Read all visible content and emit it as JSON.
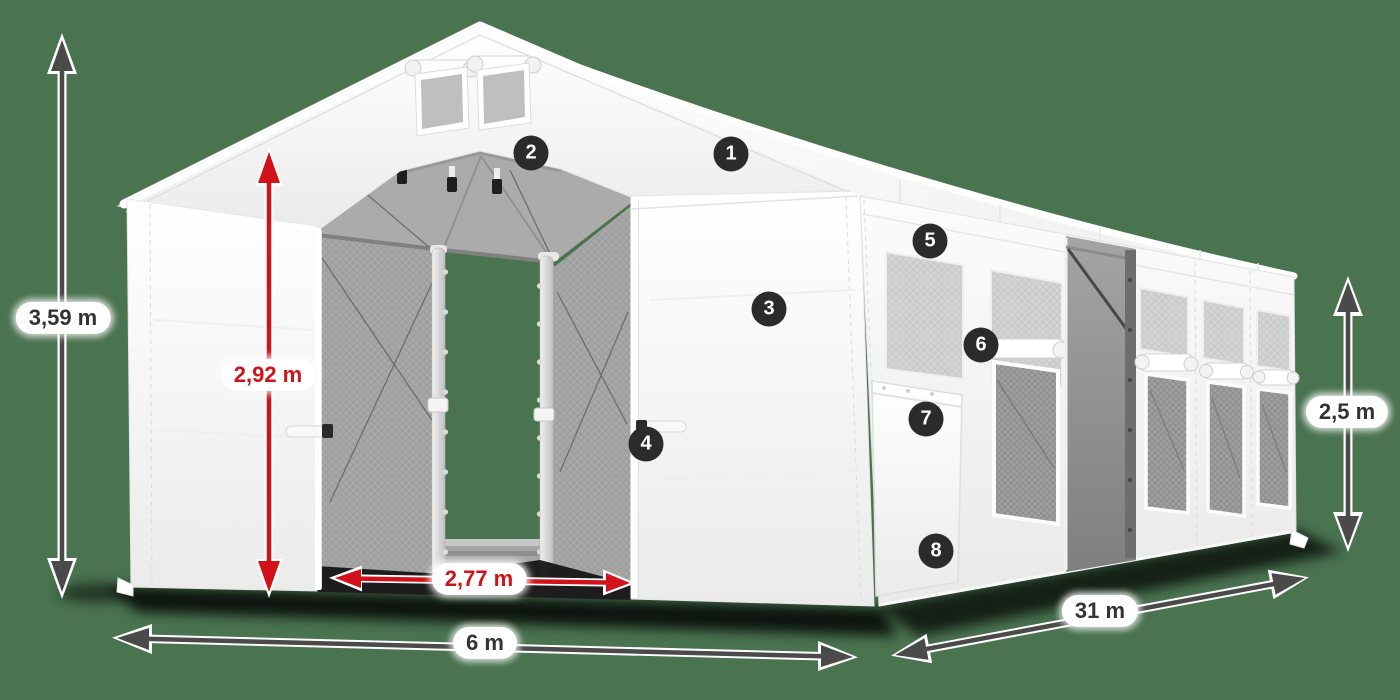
{
  "scene": {
    "background_color": "#4a7350",
    "accent_red": "#d2121a",
    "arrow_dark": "#4a4a4a",
    "badge_bg": "#2b2b2b",
    "badge_fg": "#ffffff",
    "tent_color": "#ffffff"
  },
  "dimensions": {
    "total_height": "3,59 m",
    "clearance_height": "2,92 m",
    "entrance_width": "2,77 m",
    "tent_width": "6 m",
    "tent_length": "31 m",
    "side_height": "2,5 m"
  },
  "hotspots": [
    {
      "number": "1"
    },
    {
      "number": "2"
    },
    {
      "number": "3"
    },
    {
      "number": "4"
    },
    {
      "number": "5"
    },
    {
      "number": "6"
    },
    {
      "number": "7"
    },
    {
      "number": "8"
    }
  ]
}
